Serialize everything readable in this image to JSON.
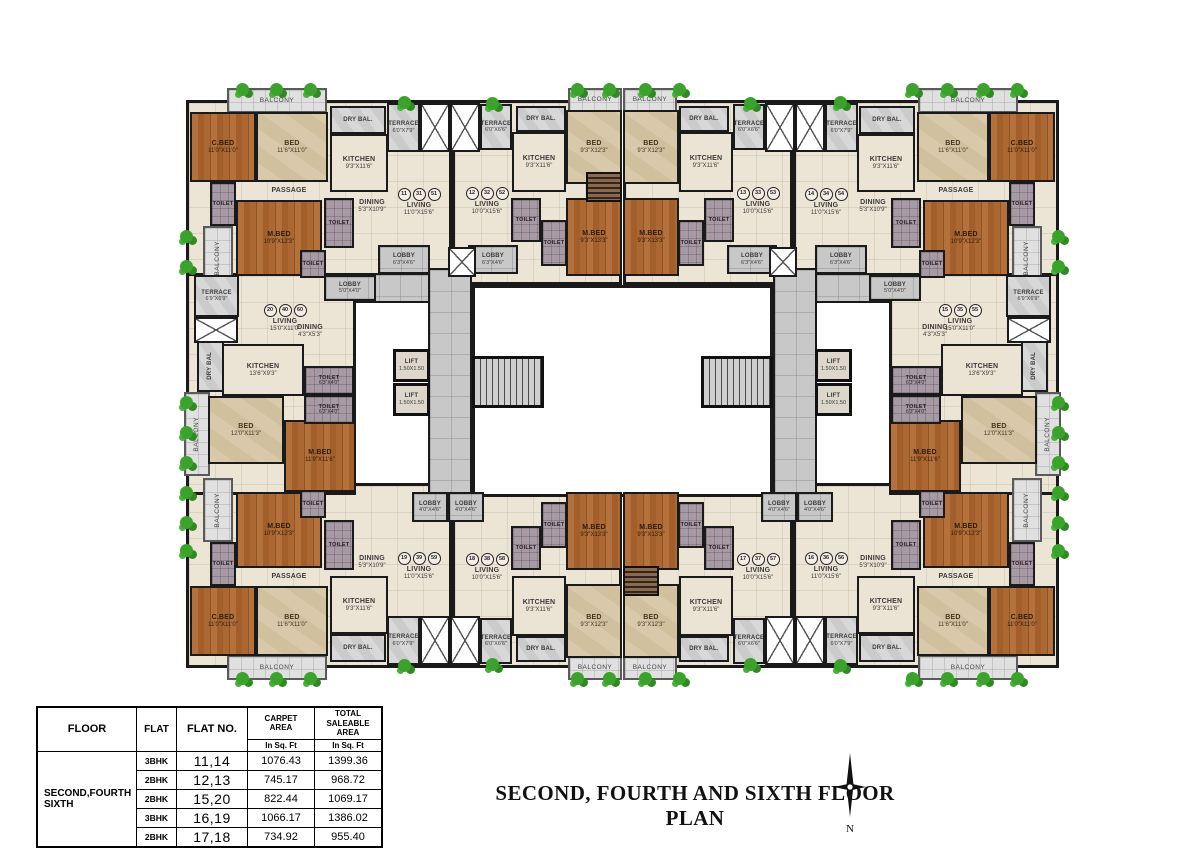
{
  "title": {
    "text": "SECOND, FOURTH AND SIXTH FLOOR PLAN"
  },
  "north": {
    "label": "N"
  },
  "area_table": {
    "headers": {
      "floor": "FLOOR",
      "flat": "FLAT",
      "flat_no": "FLAT NO.",
      "carpet": "CARPET\nAREA",
      "saleable": "TOTAL\nSALEABLE\nAREA",
      "unit": "In Sq. Ft"
    },
    "floor_value": "SECOND,FOURTH\nSIXTH",
    "rows": [
      {
        "flat": "3BHK",
        "flat_no": "11,14",
        "carpet": "1076.43",
        "saleable": "1399.36"
      },
      {
        "flat": "2BHK",
        "flat_no": "12,13",
        "carpet": "745.17",
        "saleable": "968.72"
      },
      {
        "flat": "2BHK",
        "flat_no": "15,20",
        "carpet": "822.44",
        "saleable": "1069.17"
      },
      {
        "flat": "3BHK",
        "flat_no": "16,19",
        "carpet": "1066.17",
        "saleable": "1386.02"
      },
      {
        "flat": "2BHK",
        "flat_no": "17,18",
        "carpet": "734.92",
        "saleable": "955.40"
      }
    ]
  },
  "colors": {
    "wood_floor": "#ad6a35",
    "marble_floor": "#d7c7a9",
    "living_floor": "#ece5d6",
    "corridor_tile": "#c8c8c8",
    "toilet_tile": "#a89aa4",
    "plant_green": "#3ba22c",
    "wall": "#1a1a1a"
  },
  "plan": {
    "items": [
      {
        "t": "base",
        "x": 186,
        "y": 100,
        "w": 266,
        "h": 185,
        "m": [
          "x",
          "y",
          "xy"
        ]
      },
      {
        "t": "base",
        "x": 452,
        "y": 100,
        "w": 170,
        "h": 185,
        "m": [
          "x",
          "y",
          "xy"
        ]
      },
      {
        "t": "base",
        "x": 186,
        "y": 273,
        "w": 170,
        "h": 222,
        "m": [
          "x"
        ]
      },
      {
        "t": "court",
        "x": 472,
        "y": 285,
        "w": 301,
        "h": 212
      },
      {
        "t": "tile",
        "x": 428,
        "y": 268,
        "w": 44,
        "h": 237,
        "m": [
          "x"
        ]
      },
      {
        "t": "tile",
        "x": 356,
        "y": 273,
        "w": 74,
        "h": 30,
        "m": [
          "x"
        ]
      },
      {
        "t": "tile",
        "l": "LOBBY",
        "d": "6'3\"X4'6\"",
        "x": 378,
        "y": 245,
        "w": 52,
        "h": 29,
        "m": [
          "x"
        ]
      },
      {
        "t": "tile",
        "l": "LOBBY",
        "d": "6'3\"X4'6\"",
        "x": 468,
        "y": 245,
        "w": 50,
        "h": 29,
        "m": [
          "x"
        ]
      },
      {
        "t": "tile",
        "l": "LOBBY",
        "d": "4'0\"X4'6\"",
        "x": 412,
        "y": 492,
        "w": 36,
        "h": 30,
        "m": [
          "x"
        ]
      },
      {
        "t": "tile",
        "l": "LOBBY",
        "d": "4'0\"X4'6\"",
        "x": 448,
        "y": 492,
        "w": 36,
        "h": 30,
        "m": [
          "x"
        ]
      },
      {
        "t": "tile",
        "l": "LOBBY",
        "d": "5'0\"X4'0\"",
        "x": 324,
        "y": 275,
        "w": 52,
        "h": 26,
        "m": [
          "x"
        ]
      },
      {
        "t": "balc",
        "l": "BALCONY",
        "x": 227,
        "y": 88,
        "w": 100,
        "h": 25,
        "m": [
          "x",
          "y",
          "xy"
        ]
      },
      {
        "t": "balc",
        "l": "BALCONY",
        "x": 568,
        "y": 88,
        "w": 54,
        "h": 24,
        "m": [
          "x",
          "y",
          "xy"
        ]
      },
      {
        "t": "balc",
        "l": "BALCONY",
        "v": 1,
        "x": 203,
        "y": 226,
        "w": 30,
        "h": 64,
        "m": [
          "x",
          "y",
          "xy"
        ]
      },
      {
        "t": "balc",
        "l": "BALCONY",
        "v": 1,
        "x": 184,
        "y": 392,
        "w": 26,
        "h": 84,
        "m": [
          "x"
        ]
      },
      {
        "t": "terr",
        "l": "TERRACE",
        "d": "6'0\"X7'9\"",
        "x": 387,
        "y": 103,
        "w": 33,
        "h": 49,
        "m": [
          "x",
          "y",
          "xy"
        ]
      },
      {
        "t": "terr",
        "l": "TERRACE",
        "d": "6'0\"X6'6\"",
        "x": 480,
        "y": 104,
        "w": 32,
        "h": 46,
        "m": [
          "x",
          "y",
          "xy"
        ]
      },
      {
        "t": "terr",
        "l": "TERRACE",
        "d": "6'9\"X6'9\"",
        "x": 194,
        "y": 275,
        "w": 45,
        "h": 42,
        "m": [
          "x"
        ]
      },
      {
        "t": "terr",
        "l": "DRY BAL.",
        "x": 330,
        "y": 106,
        "w": 56,
        "h": 28,
        "m": [
          "x",
          "y",
          "xy"
        ]
      },
      {
        "t": "terr",
        "l": "DRY BAL.",
        "x": 516,
        "y": 106,
        "w": 50,
        "h": 26,
        "m": [
          "x",
          "y",
          "xy"
        ]
      },
      {
        "t": "terr",
        "l": "DRY BAL",
        "v": 1,
        "x": 197,
        "y": 340,
        "w": 27,
        "h": 52,
        "m": [
          "x"
        ]
      },
      {
        "t": "shaft",
        "x": 420,
        "y": 103,
        "w": 30,
        "h": 49,
        "m": [
          "x",
          "y",
          "xy"
        ]
      },
      {
        "t": "shaft",
        "x": 450,
        "y": 103,
        "w": 30,
        "h": 49,
        "m": [
          "x",
          "y",
          "xy"
        ]
      },
      {
        "t": "shaft",
        "x": 194,
        "y": 317,
        "w": 44,
        "h": 26,
        "m": [
          "x"
        ]
      },
      {
        "t": "shaft",
        "x": 448,
        "y": 247,
        "w": 28,
        "h": 30,
        "m": [
          "x"
        ]
      },
      {
        "t": "cream",
        "l": "KITCHEN",
        "d": "9'3\"X11'6\"",
        "x": 330,
        "y": 134,
        "w": 58,
        "h": 58,
        "m": [
          "x",
          "y",
          "xy"
        ]
      },
      {
        "t": "cream",
        "l": "KITCHEN",
        "d": "9'3\"X11'6\"",
        "x": 512,
        "y": 132,
        "w": 54,
        "h": 60,
        "m": [
          "x",
          "y",
          "xy"
        ]
      },
      {
        "t": "cream",
        "l": "KITCHEN",
        "d": "13'6\"X9'3\"",
        "x": 222,
        "y": 344,
        "w": 82,
        "h": 52,
        "m": [
          "x"
        ]
      },
      {
        "t": "wood",
        "l": "C.BED",
        "d": "11'0\"X11'0\"",
        "x": 190,
        "y": 112,
        "w": 66,
        "h": 70,
        "m": [
          "x",
          "y",
          "xy"
        ]
      },
      {
        "t": "beige",
        "l": "BED",
        "d": "11'6\"X11'0\"",
        "x": 256,
        "y": 112,
        "w": 72,
        "h": 70,
        "m": [
          "x",
          "y",
          "xy"
        ]
      },
      {
        "t": "wood",
        "l": "M.BED",
        "d": "10'9\"X12'3\"",
        "x": 236,
        "y": 200,
        "w": 86,
        "h": 76,
        "m": [
          "x",
          "y",
          "xy"
        ]
      },
      {
        "t": "beige",
        "l": "BED",
        "d": "9'3\"X12'3\"",
        "x": 566,
        "y": 110,
        "w": 56,
        "h": 74,
        "m": [
          "x",
          "y",
          "xy"
        ]
      },
      {
        "t": "wood",
        "l": "M.BED",
        "d": "9'3\"X13'3\"",
        "x": 566,
        "y": 198,
        "w": 56,
        "h": 78,
        "m": [
          "x",
          "y",
          "xy"
        ]
      },
      {
        "t": "beige",
        "l": "BED",
        "d": "12'0\"X11'3\"",
        "x": 208,
        "y": 396,
        "w": 76,
        "h": 68,
        "m": [
          "x"
        ]
      },
      {
        "t": "wood",
        "l": "M.BED",
        "d": "11'9\"X11'6\"",
        "x": 284,
        "y": 420,
        "w": 72,
        "h": 72,
        "m": [
          "x"
        ]
      },
      {
        "t": "toilet",
        "l": "TOILET",
        "x": 210,
        "y": 182,
        "w": 26,
        "h": 44,
        "m": [
          "x",
          "y",
          "xy"
        ]
      },
      {
        "t": "toilet",
        "l": "TOILET",
        "x": 324,
        "y": 198,
        "w": 30,
        "h": 50,
        "m": [
          "x",
          "y",
          "xy"
        ]
      },
      {
        "t": "toilet",
        "l": "TOILET",
        "x": 300,
        "y": 250,
        "w": 26,
        "h": 28,
        "m": [
          "x",
          "y",
          "xy"
        ]
      },
      {
        "t": "toilet",
        "l": "TOILET",
        "x": 511,
        "y": 198,
        "w": 30,
        "h": 44,
        "m": [
          "x",
          "y",
          "xy"
        ]
      },
      {
        "t": "toilet",
        "l": "TOILET",
        "x": 541,
        "y": 220,
        "w": 26,
        "h": 46,
        "m": [
          "x",
          "y",
          "xy"
        ]
      },
      {
        "t": "toilet",
        "l": "TOILET",
        "d": "6'3\"X4'0\"",
        "x": 304,
        "y": 366,
        "w": 50,
        "h": 29,
        "m": [
          "x"
        ]
      },
      {
        "t": "toilet",
        "l": "TOILET",
        "d": "6'3\"X4'0\"",
        "x": 304,
        "y": 395,
        "w": 50,
        "h": 29,
        "m": [
          "x"
        ]
      },
      {
        "t": "open",
        "l": "PASSAGE",
        "x": 256,
        "y": 182,
        "w": 66,
        "h": 18,
        "m": [
          "x",
          "y",
          "xy"
        ]
      },
      {
        "t": "open",
        "l": "DINING",
        "d": "5'3\"X10'9\"",
        "x": 344,
        "y": 186,
        "w": 56,
        "h": 40,
        "m": [
          "x",
          "y",
          "xy"
        ]
      },
      {
        "t": "open",
        "l": "DINING",
        "d": "4'3\"X5'3\"",
        "x": 282,
        "y": 312,
        "w": 56,
        "h": 38,
        "m": [
          "x"
        ]
      },
      {
        "t": "open",
        "l": "LIVING",
        "d": "11'0\"X15'6\"",
        "c": [
          "11",
          "31",
          "51"
        ],
        "x": 388,
        "y": 152,
        "w": 62,
        "h": 100
      },
      {
        "t": "open",
        "l": "LIVING",
        "d": "10'0\"X15'6\"",
        "c": [
          "12",
          "32",
          "52"
        ],
        "x": 455,
        "y": 150,
        "w": 64,
        "h": 102
      },
      {
        "t": "open",
        "l": "LIVING",
        "d": "10'0\"X15'6\"",
        "c": [
          "13",
          "33",
          "53"
        ],
        "x": 726,
        "y": 150,
        "w": 64,
        "h": 102
      },
      {
        "t": "open",
        "l": "LIVING",
        "d": "11'0\"X15'6\"",
        "c": [
          "14",
          "34",
          "54"
        ],
        "x": 795,
        "y": 152,
        "w": 62,
        "h": 100
      },
      {
        "t": "open",
        "l": "LIVING",
        "d": "15'0\"X11'0\"",
        "c": [
          "20",
          "40",
          "60"
        ],
        "x": 237,
        "y": 283,
        "w": 96,
        "h": 70
      },
      {
        "t": "open",
        "l": "LIVING",
        "d": "15'0\"X11'0\"",
        "c": [
          "15",
          "35",
          "55"
        ],
        "x": 912,
        "y": 283,
        "w": 96,
        "h": 70
      },
      {
        "t": "open",
        "l": "LIVING",
        "d": "11'0\"X15'6\"",
        "c": [
          "19",
          "39",
          "59"
        ],
        "x": 388,
        "y": 516,
        "w": 62,
        "h": 100
      },
      {
        "t": "open",
        "l": "LIVING",
        "d": "10'0\"X15'6\"",
        "c": [
          "18",
          "38",
          "58"
        ],
        "x": 455,
        "y": 516,
        "w": 64,
        "h": 102
      },
      {
        "t": "open",
        "l": "LIVING",
        "d": "10'0\"X15'6\"",
        "c": [
          "17",
          "37",
          "57"
        ],
        "x": 726,
        "y": 516,
        "w": 64,
        "h": 102
      },
      {
        "t": "open",
        "l": "LIVING",
        "d": "11'0\"X15'6\"",
        "c": [
          "16",
          "36",
          "56"
        ],
        "x": 795,
        "y": 516,
        "w": 62,
        "h": 100
      },
      {
        "t": "lift",
        "l": "LIFT",
        "d": "1.50X1.50",
        "x": 393,
        "y": 349,
        "w": 37,
        "h": 33,
        "m": [
          "x"
        ]
      },
      {
        "t": "lift",
        "l": "LIFT",
        "d": "1.50X1.50",
        "x": 393,
        "y": 383,
        "w": 37,
        "h": 33,
        "m": [
          "x"
        ]
      },
      {
        "t": "stairs",
        "x": 472,
        "y": 356,
        "w": 72,
        "h": 52,
        "m": [
          "x"
        ]
      },
      {
        "t": "flight",
        "x": 586,
        "y": 172,
        "w": 36,
        "h": 30
      },
      {
        "t": "flight",
        "x": 623,
        "y": 566,
        "w": 36,
        "h": 30
      }
    ],
    "plants": [
      [
        236,
        83
      ],
      [
        270,
        83
      ],
      [
        304,
        83
      ],
      [
        398,
        96
      ],
      [
        486,
        97
      ],
      [
        571,
        83
      ],
      [
        603,
        83
      ],
      [
        639,
        83
      ],
      [
        673,
        83
      ],
      [
        744,
        97
      ],
      [
        834,
        96
      ],
      [
        906,
        83
      ],
      [
        941,
        83
      ],
      [
        977,
        83
      ],
      [
        1011,
        83
      ],
      [
        180,
        230
      ],
      [
        180,
        260
      ],
      [
        180,
        396
      ],
      [
        180,
        426
      ],
      [
        180,
        456
      ],
      [
        180,
        486
      ],
      [
        180,
        516
      ],
      [
        180,
        544
      ],
      [
        1052,
        230
      ],
      [
        1052,
        260
      ],
      [
        1052,
        396
      ],
      [
        1052,
        426
      ],
      [
        1052,
        456
      ],
      [
        1052,
        486
      ],
      [
        1052,
        516
      ],
      [
        1052,
        544
      ],
      [
        236,
        672
      ],
      [
        270,
        672
      ],
      [
        304,
        672
      ],
      [
        398,
        659
      ],
      [
        486,
        658
      ],
      [
        571,
        672
      ],
      [
        603,
        672
      ],
      [
        639,
        672
      ],
      [
        673,
        672
      ],
      [
        744,
        658
      ],
      [
        834,
        659
      ],
      [
        906,
        672
      ],
      [
        941,
        672
      ],
      [
        977,
        672
      ],
      [
        1011,
        672
      ]
    ]
  }
}
